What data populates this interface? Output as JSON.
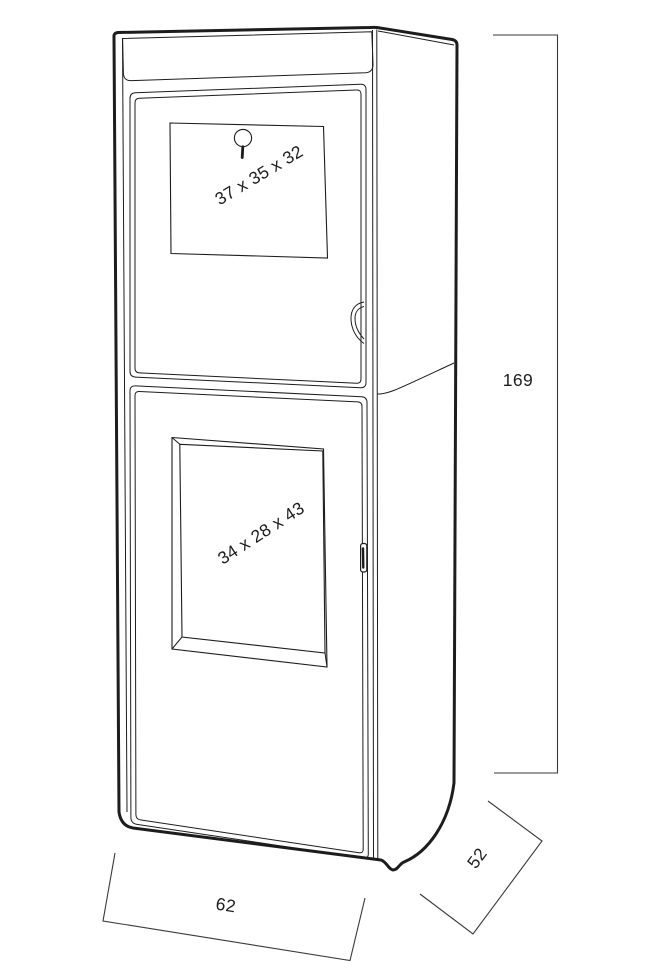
{
  "drawing": {
    "upper_compartment_label": "37 x 35 x 32",
    "lower_compartment_label": "34 x 28 x 43",
    "dimensions": {
      "height": "169",
      "width": "62",
      "depth": "52"
    },
    "colors": {
      "line": "#1d1d1d",
      "dimension_line": "#3a3a3a",
      "background": "#ffffff"
    }
  }
}
